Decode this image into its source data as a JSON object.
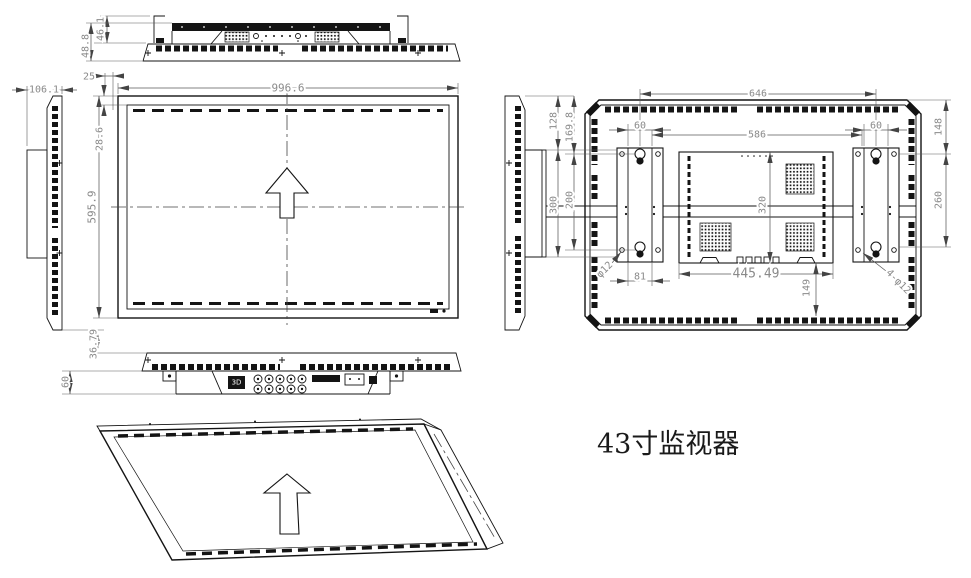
{
  "title_label": "43寸监视器",
  "dims": {
    "top": {
      "hook": "46.1",
      "body": "48.8",
      "lip": "25"
    },
    "side": {
      "depth": "106.1"
    },
    "front": {
      "width": "996.6",
      "height": "595.9",
      "bezel_top": "28.6"
    },
    "mount_left": {
      "top_gap": "128",
      "hole_top": "169.8",
      "bracket_span": "300",
      "hole_span": "200"
    },
    "rear": {
      "hook_span": "646",
      "inner_span": "586",
      "bracket_left": "60",
      "bracket_right": "60",
      "right_top": "148",
      "right_span": "260",
      "box_height": "320",
      "box_width": "445.49",
      "box_bottom": "149",
      "bracket_width": "81",
      "hole_dia": "φ12",
      "holes_dia": "4-φ12"
    },
    "bottom": {
      "face": "36.79",
      "recess": "60"
    }
  },
  "ports": {
    "label_3d": "3D"
  }
}
